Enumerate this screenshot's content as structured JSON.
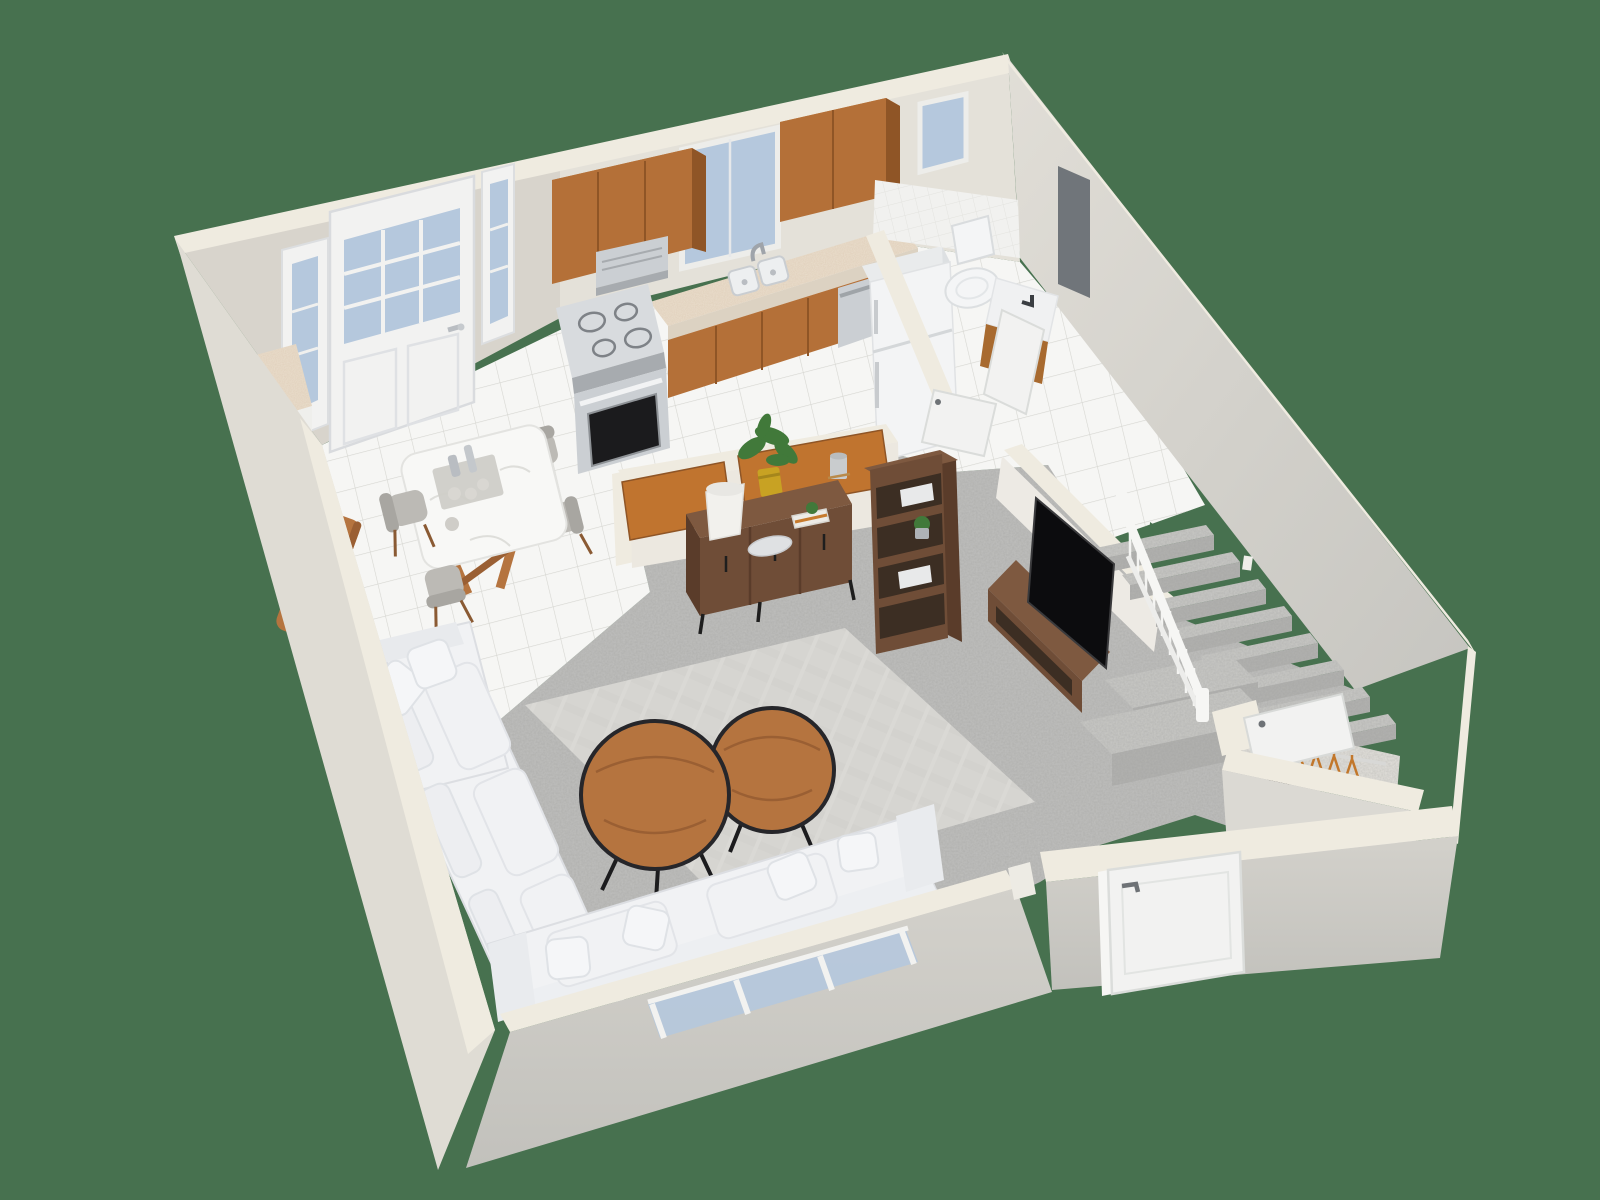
{
  "scene": {
    "title": "3D isometric floor plan rendering of an apartment first floor on a green background",
    "style": "architectural dollhouse cutaway view",
    "background_color": "#47714F"
  },
  "colors": {
    "background": "#47714F",
    "wall_cap": "#EFEBE0",
    "wall_face": "#D8D4CC",
    "wall_face_light": "#E4E1D9",
    "wall_right_a": "#E1DED7",
    "wall_right_b": "#C6C5C0",
    "wall_exterior": "#DFDCD4",
    "wall_bottom_a": "#D3D1CB",
    "wall_bottom_b": "#C2C1BC",
    "tile": "#F6F6F4",
    "grout": "#D6D6D1",
    "carpet": "#BFBFBD",
    "stair_tread": "#C9C9C6",
    "stair_riser": "#B2B2B0",
    "rug": "#D6D5D1",
    "cabinet_wood": "#B47038",
    "cabinet_wood_dark": "#8F5526",
    "cabinet_wood_top": "#C6854A",
    "bar_wood": "#C0742F",
    "granite": "#EADFCE",
    "steel": "#CBCFD3",
    "steel_dark": "#A7ABAF",
    "appliance_white": "#F3F4F5",
    "glass": "#B5C8DD",
    "furn_wood": "#6F4D37",
    "furn_wood_dark": "#5A3C2A",
    "furn_wood_top": "#7E5940",
    "table_wood": "#B5743F",
    "marble": "#F8F8F6",
    "sofa": "#F1F2F4",
    "sofa_shadow": "#DCDEE2",
    "sofa_pillow": "#F5F6F8",
    "tv_black": "#0C0C0E",
    "mirror": "#70757A",
    "plant": "#41793A",
    "pot": "#C8A223",
    "hanger": "#C2772B",
    "door_white": "#F2F2F1",
    "door_edge": "#D8DAD8",
    "chair_gray": "#BCBAB5",
    "chair_gray_dark": "#A8A6A1",
    "garment_dark": "#2E2A26"
  },
  "rooms": [
    {
      "id": "entry",
      "label": "Entry",
      "features": [
        "glass-panel front door",
        "two sidelight windows",
        "granite console",
        "wood bench"
      ]
    },
    {
      "id": "kitchen",
      "label": "Kitchen",
      "features": [
        "two upper wood cabinets",
        "range hood",
        "window",
        "granite counter",
        "double sink",
        "stove",
        "dishwasher",
        "refrigerator",
        "half wall with wood bar tops"
      ]
    },
    {
      "id": "dining",
      "label": "Dining area",
      "features": [
        "marble-top table",
        "4 upholstered chairs",
        "serving tray with bottles and cups"
      ]
    },
    {
      "id": "living",
      "label": "Living room",
      "features": [
        "L-shaped white sectional",
        "second white sofa",
        "two round wood coffee tables",
        "area rug",
        "media console with TV",
        "sideboard with lamp",
        "bookshelf"
      ]
    },
    {
      "id": "bathroom",
      "label": "Bathroom",
      "features": [
        "toilet",
        "wood vanity with sink",
        "wall mirror",
        "tiled wainscot",
        "small window",
        "open door"
      ]
    },
    {
      "id": "stairs",
      "label": "Staircase",
      "features": [
        "carpeted treads",
        "white railing with balusters",
        "two landing platforms"
      ]
    },
    {
      "id": "closet",
      "label": "Under-stair closet",
      "features": [
        "hanging rod",
        "wood hangers",
        "dark garment",
        "open door"
      ]
    },
    {
      "id": "patio",
      "label": "Sliding glass door wall"
    },
    {
      "id": "side-door",
      "label": "Side entry door"
    }
  ],
  "counts": {
    "dining_chairs": 4,
    "coffee_tables": 2,
    "stair_treads": 8,
    "closet_hangers": 6,
    "upper_cabinet_sections": 2,
    "sofas": 2
  }
}
